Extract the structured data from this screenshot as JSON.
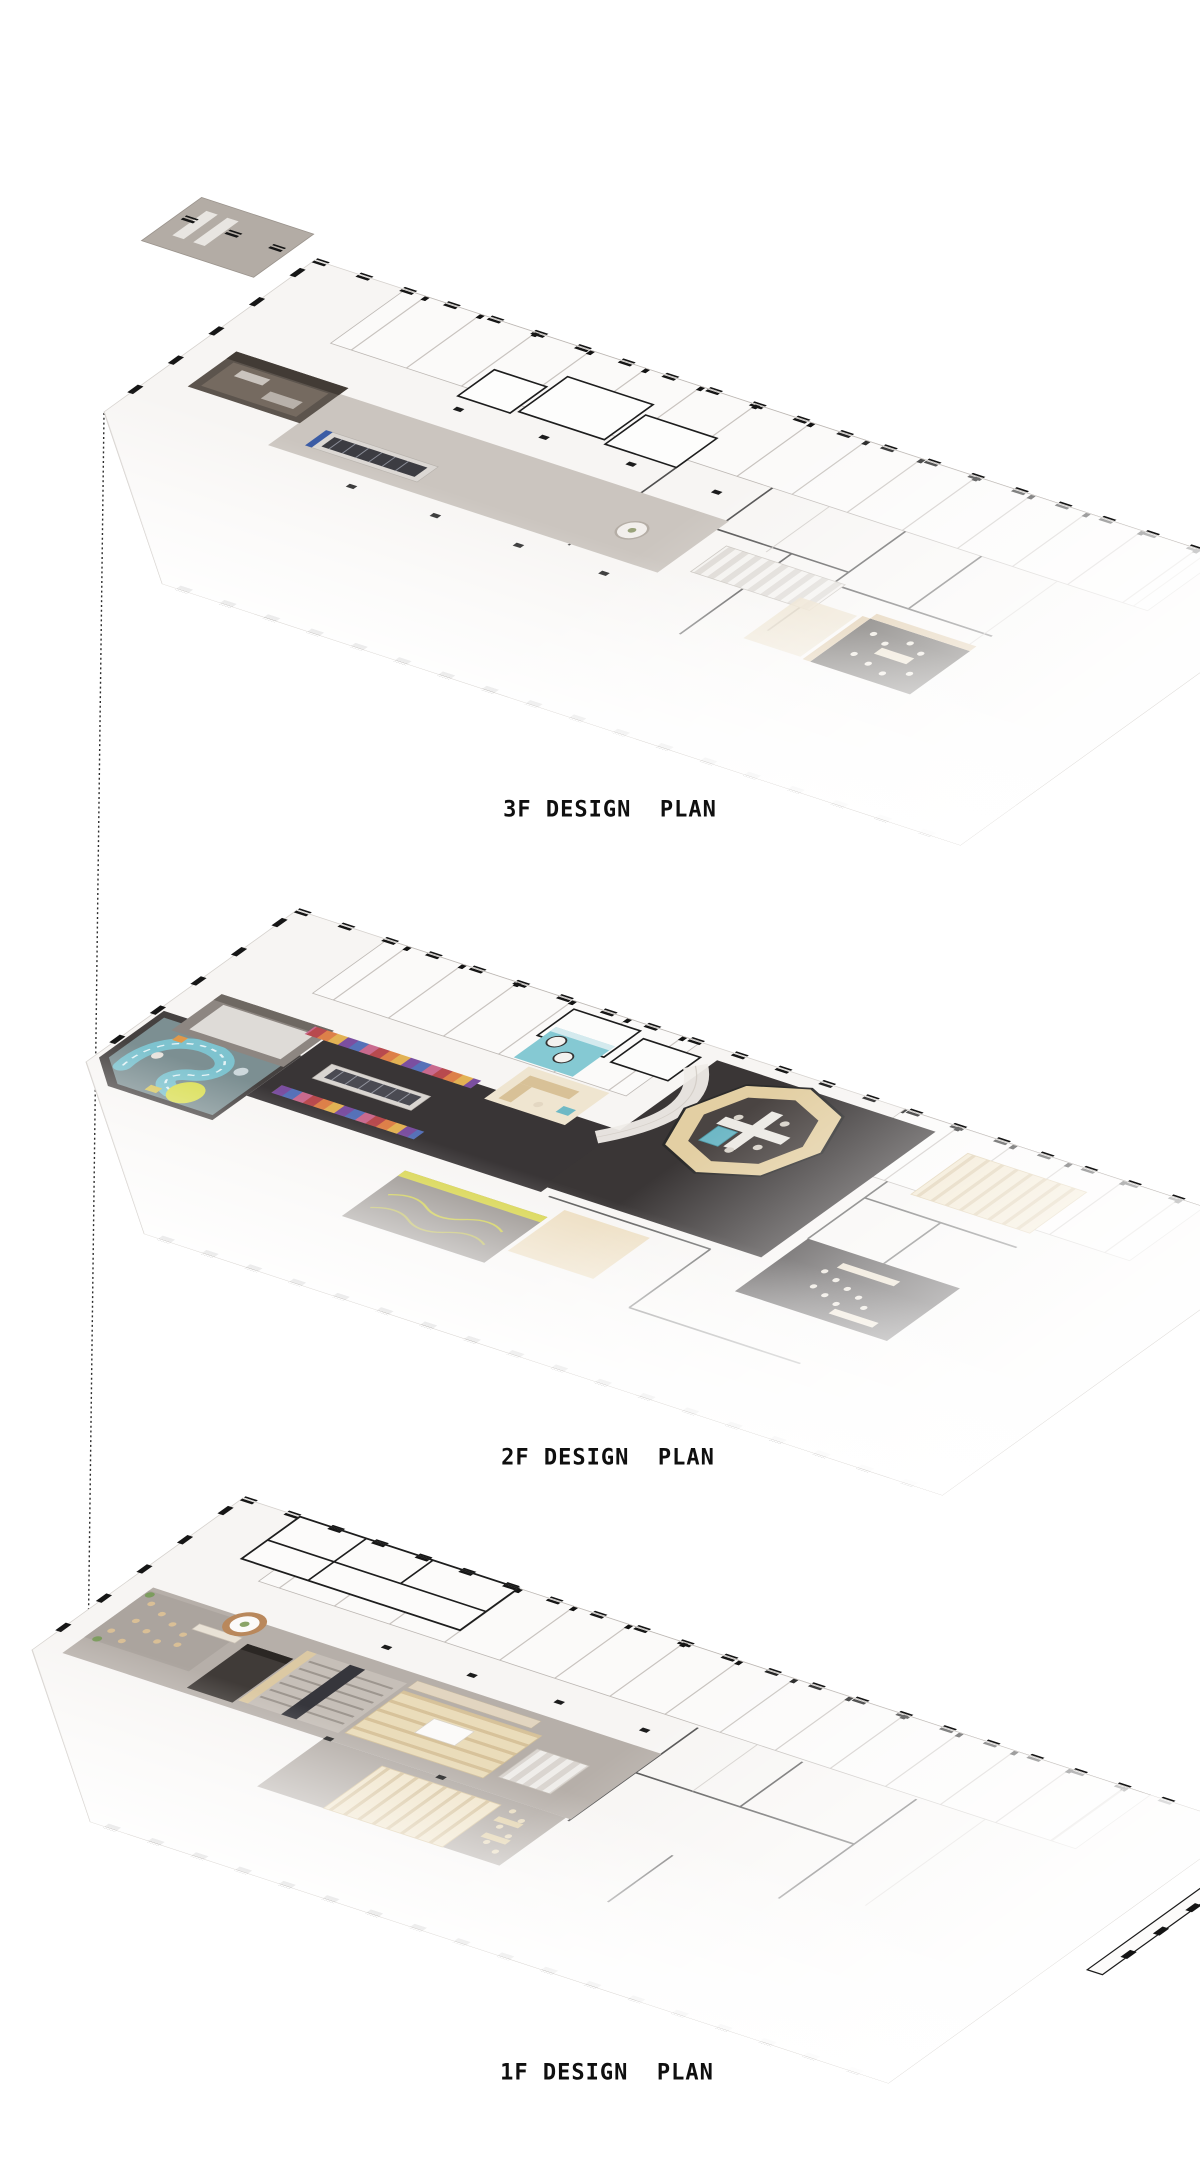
{
  "document": {
    "kind": "architectural axonometric floor plan presentation",
    "background_color": "#ffffff"
  },
  "connector": {
    "style": "dotted projection line",
    "color": "#2e2e2e"
  },
  "floors": [
    {
      "id": "3f",
      "label": "3F DESIGN  PLAN",
      "features": [
        "core-box",
        "escalator",
        "corridor",
        "skylight-strip",
        "dining-area",
        "office-rooms"
      ]
    },
    {
      "id": "2f",
      "label": "2F DESIGN  PLAN",
      "features": [
        "kids-play-area",
        "rainbow-bookshelves",
        "escalator",
        "octagon-pavilion",
        "spa-pool-room",
        "lounge-sofa-room",
        "shelving-rows",
        "activity-room",
        "cafe-tables"
      ]
    },
    {
      "id": "1f",
      "label": "1F DESIGN  PLAN",
      "features": [
        "cafe-seating",
        "reception-desk",
        "dark-portal",
        "amphitheater-steps",
        "tiered-seating",
        "bookshelf-rows",
        "reading-tables",
        "detached-wall"
      ]
    }
  ],
  "palette": {
    "wall_ink": "#1a1a1a",
    "slab": "#f7f5f3",
    "corridor_gray": "#c9c3bd",
    "concrete_gray": "#b3aca6",
    "dark_floor": "#393536",
    "wood_beige": "#e3cfa3",
    "wood_brown": "#b9885c",
    "teal": "#85c9d3",
    "yellow": "#dade54",
    "rainbow": [
      "#b84a4e",
      "#dd8049",
      "#e2b254",
      "#7b4fa0",
      "#5671b8",
      "#c96a8e"
    ]
  }
}
